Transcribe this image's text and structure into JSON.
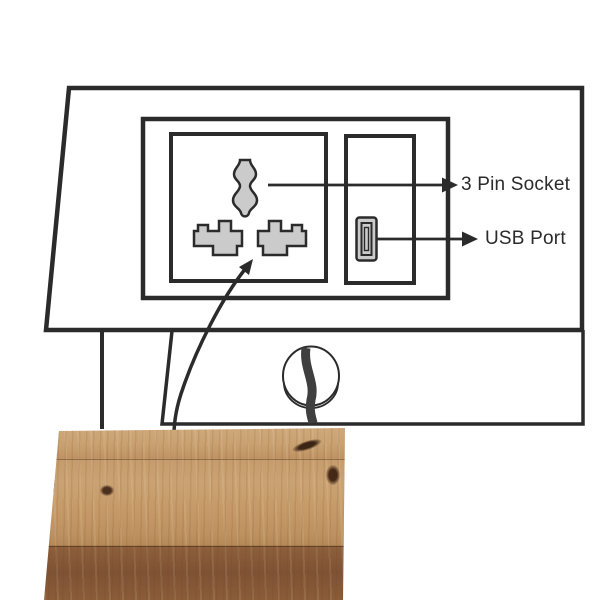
{
  "diagram": {
    "pin_socket_label": "3 Pin Socket",
    "usb_port_label": "USB Port"
  },
  "colors": {
    "line": "#2b2b2b",
    "slot_fill": "#cbcbcb",
    "cable": "#3f3f3f",
    "ring": "#333333",
    "plate": "#9e9e9e",
    "wood_light": "#c49a6b",
    "wood_dark": "#8a5c3a",
    "background": "#ffffff"
  }
}
